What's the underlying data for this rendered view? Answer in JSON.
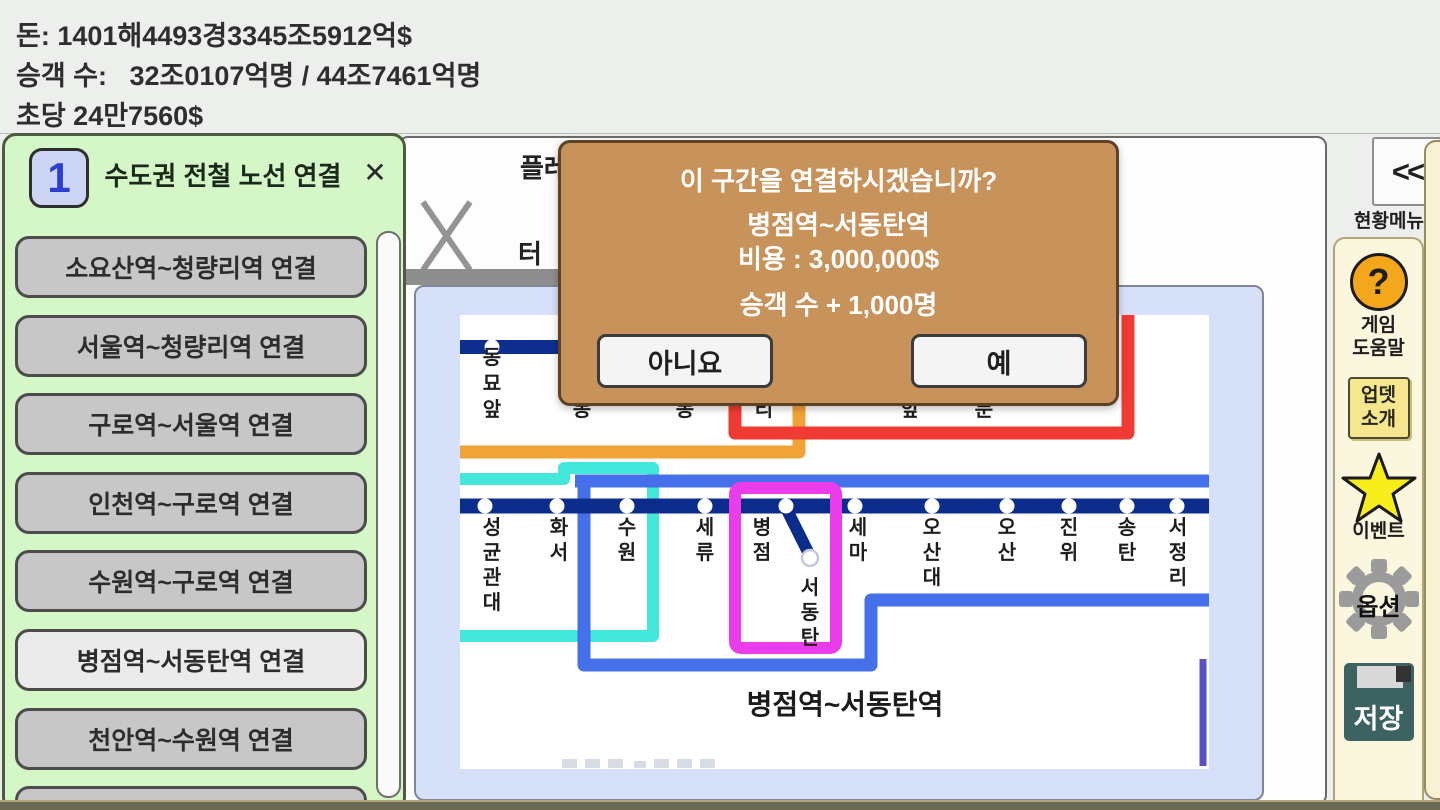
{
  "hud": {
    "money": "돈: 1401해4493경3345조5912억$",
    "passengers": "승객 수:   32조0107억명 / 44조7461억명",
    "per_second": "초당 24만7560$"
  },
  "line_panel": {
    "badge": "1",
    "title": "수도권 전철 노선 연결",
    "close": "✕",
    "buttons": [
      {
        "label": "소요산역~청량리역 연결",
        "active": false
      },
      {
        "label": "서울역~청량리역 연결",
        "active": false
      },
      {
        "label": "구로역~서울역 연결",
        "active": false
      },
      {
        "label": "인천역~구로역 연결",
        "active": false
      },
      {
        "label": "수원역~구로역 연결",
        "active": false
      },
      {
        "label": "병점역~서동탄역 연결",
        "active": true
      },
      {
        "label": "천안역~수원역 연결",
        "active": false
      }
    ]
  },
  "window": {
    "tab_fragment_top": "플레",
    "tab_fragment_bottom": "터"
  },
  "dialog": {
    "question": "이 구간을 연결하시겠습니까?",
    "section": "병점역~서동탄역",
    "cost": "비용 : 3,000,000$",
    "passenger_bonus": "승객 수 + 1,000명",
    "no_label": "아니요",
    "yes_label": "예"
  },
  "sidebar": {
    "collapse_label": "<<",
    "menu_label": "현황메뉴",
    "help_icon": "?",
    "help_line1": "게임",
    "help_line2": "도움말",
    "update_line1": "업뎃",
    "update_line2": "소개",
    "event_label": "이벤트",
    "options_label": "옵션",
    "save_label": "저장"
  },
  "map": {
    "top_station": {
      "name": "동묘앞",
      "x": 490
    },
    "top_partial_chars": [
      {
        "ch": "동",
        "x": 580
      },
      {
        "ch": "동",
        "x": 683
      },
      {
        "ch": "리",
        "x": 762
      },
      {
        "ch": "앞",
        "x": 908
      },
      {
        "ch": "문",
        "x": 982
      }
    ],
    "stations": [
      {
        "name": "성균관대",
        "dot_x": 483,
        "label_x": 490
      },
      {
        "name": "화서",
        "dot_x": 555,
        "label_x": 557
      },
      {
        "name": "수원",
        "dot_x": 625,
        "label_x": 625
      },
      {
        "name": "세류",
        "dot_x": 703,
        "label_x": 703
      },
      {
        "name": "병점",
        "dot_x": 784,
        "label_x": 760
      },
      {
        "name": "세마",
        "dot_x": 853,
        "label_x": 856
      },
      {
        "name": "오산대",
        "dot_x": 930,
        "label_x": 930
      },
      {
        "name": "오산",
        "dot_x": 1005,
        "label_x": 1005
      },
      {
        "name": "진위",
        "dot_x": 1067,
        "label_x": 1067
      },
      {
        "name": "송탄",
        "dot_x": 1125,
        "label_x": 1125
      },
      {
        "name": "서정리",
        "dot_x": 1175,
        "label_x": 1176
      }
    ],
    "branch_station": {
      "name": "서동탄",
      "x": 808,
      "node_x": 808,
      "node_y": 556
    },
    "caption": "병점역~서동탄역"
  },
  "colors": {
    "dialog_bg": "#c7935b",
    "panel_green": "#d5f6c7",
    "button_gray": "#c7c7c7",
    "button_active": "#ebebeb",
    "line_navy": "#0c2c8c",
    "line_royal_blue": "#4670ea",
    "line_cyan": "#43e8da",
    "line_magenta": "#ea3cea",
    "line_red": "#ef3b33",
    "line_orange": "#f2a338",
    "line_indigo": "#5a50c8",
    "help_orange": "#f4a71b",
    "star_yellow": "#f7ee1c",
    "save_teal": "#3d6262"
  }
}
